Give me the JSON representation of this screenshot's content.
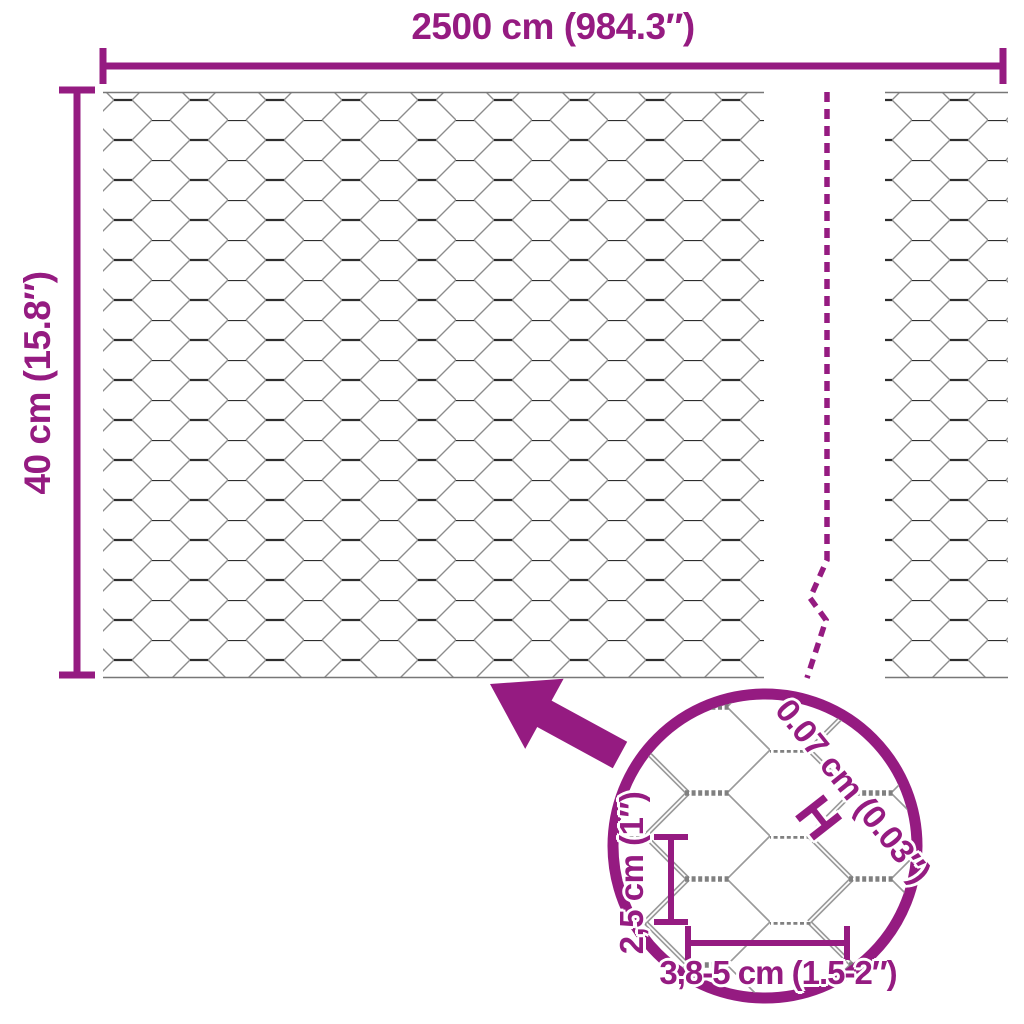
{
  "labels": {
    "total_width": "2500 cm (984.3″)",
    "roll_height": "40 cm (15.8″)"
  },
  "detail": {
    "wire_thickness": "0.07 cm (0.03″)",
    "thickness_marker": "H",
    "mesh_height": "2,5 cm (1″)",
    "mesh_width": "3,8-5 cm (1.5-2″)"
  },
  "colors": {
    "accent_purple": "#951b81",
    "mesh_twist_dark": "#2e2e2e",
    "mesh_wire_gray": "#8c8c8c",
    "detail_wire_gray": "#9a9a9a",
    "background": "#ffffff"
  }
}
